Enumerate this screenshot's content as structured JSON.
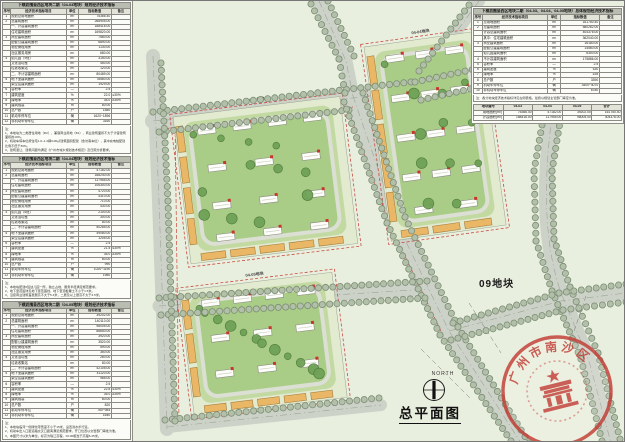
{
  "title_block": {
    "drawing_title": "总平面图",
    "north_label": "NORTH",
    "parcel_label": "09地块"
  },
  "stamp": {
    "arc_text": "广州市南沙区人民政府",
    "color": "#c23c35"
  },
  "plan": {
    "block_labels": [
      "04-03地块",
      "04-04地块",
      "04-05地块"
    ],
    "colors": {
      "background": "#e9efde",
      "road": "#cdd2c8",
      "street_tree": "#b2c0a9",
      "podium": "#e9b766",
      "tower": "#fdfdf9",
      "tree": "#6fa257",
      "red_line": "#c84b3f",
      "unit_tag": "#c8362b"
    }
  },
  "left_tables": [
    {
      "title": "下横沥围垦西区地块二期（04-03地块）规划经济技术指标",
      "header": [
        "序号",
        "经济技术指标项目",
        "单位",
        "指标数值",
        "备注"
      ],
      "rows": [
        [
          "1",
          "规划总用地面积",
          "m²",
          "75366.40",
          ""
        ],
        [
          "2",
          "总建筑面积",
          "m²",
          "268905.00",
          ""
        ],
        [
          "",
          "一、计容建筑面积",
          "m²",
          "188416.00",
          ""
        ],
        [
          "",
          "住宅建筑面积",
          "m²",
          "169820.00",
          ""
        ],
        [
          "3",
          "商业建筑面积",
          "m²",
          "7560.00",
          ""
        ],
        [
          "",
          "配套公建建筑面积",
          "m²",
          "6890.00",
          ""
        ],
        [
          "",
          "物业管理用房",
          "m²",
          "1130.00",
          ""
        ],
        [
          "",
          "社区服务用房",
          "m²",
          "680.00",
          ""
        ],
        [
          "4",
          "幼儿园（9班）",
          "m²",
          "3150.00",
          ""
        ],
        [
          "",
          "文化活动室",
          "m²",
          "450.00",
          ""
        ],
        [
          "",
          "垃圾收集站",
          "m²",
          "120.00",
          ""
        ],
        [
          "",
          "二、不计容建筑面积",
          "m²",
          "80489.00",
          ""
        ],
        [
          "5",
          "地下室建筑面积",
          "m²",
          "78560.00",
          ""
        ],
        [
          "",
          "架空层建筑面积",
          "m²",
          "1929.00",
          ""
        ],
        [
          "6",
          "容积率",
          "—",
          "2.5",
          ""
        ],
        [
          "7",
          "建筑密度",
          "%",
          "22.0",
          "≤30%"
        ],
        [
          "8",
          "绿地率",
          "%",
          "35.0",
          "≥35%"
        ],
        [
          "9",
          "建筑限高",
          "m",
          "80.00",
          ""
        ],
        [
          "10",
          "总户数",
          "户",
          "1580",
          ""
        ],
        [
          "11",
          "机动车停车位",
          "辆",
          "1620~1896",
          ""
        ],
        [
          "12",
          "非机动车停车位",
          "辆",
          "3160",
          ""
        ]
      ],
      "notes": [
        "注：",
        "1、本地块为二类居住用地（R2），兼容商业用地（B1），商业建筑面积不大于计容建筑面积的10%。",
        "2、机动车停车位按住宅1.0~1.2辆/100㎡建筑面积配建（含访客车位），其中充电桩配建比例不低于30%。",
        "3、建筑退让、建筑间距均满足《广州市城乡规划技术规定》及日照分析要求。"
      ]
    },
    {
      "title": "下横沥围垦西区地块二期（04-04地块）规划经济技术指标",
      "header": [
        "序号",
        "经济技术指标项目",
        "单位",
        "指标数值",
        "备注"
      ],
      "rows": [
        [
          "1",
          "规划总用地面积",
          "m²",
          "47182.00",
          ""
        ],
        [
          "2",
          "总建筑面积",
          "m²",
          "168240.00",
          ""
        ],
        [
          "",
          "一、计容建筑面积",
          "m²",
          "117955.00",
          ""
        ],
        [
          "",
          "住宅建筑面积",
          "m²",
          "106300.00",
          ""
        ],
        [
          "3",
          "商业建筑面积",
          "m²",
          "4720.00",
          ""
        ],
        [
          "",
          "配套公建建筑面积",
          "m²",
          "4310.00",
          ""
        ],
        [
          "",
          "物业管理用房",
          "m²",
          "710.00",
          ""
        ],
        [
          "",
          "社区服务用房",
          "m²",
          "430.00",
          ""
        ],
        [
          "4",
          "幼儿园（6班）",
          "m²",
          "2100.00",
          ""
        ],
        [
          "",
          "文化活动室",
          "m²",
          "300.00",
          ""
        ],
        [
          "",
          "垃圾收集站",
          "m²",
          "80.00",
          ""
        ],
        [
          "",
          "二、不计容建筑面积",
          "m²",
          "50285.00",
          ""
        ],
        [
          "5",
          "地下室建筑面积",
          "m²",
          "49080.00",
          ""
        ],
        [
          "",
          "架空层建筑面积",
          "m²",
          "1205.00",
          ""
        ],
        [
          "6",
          "容积率",
          "—",
          "2.5",
          ""
        ],
        [
          "7",
          "建筑密度",
          "%",
          "21.5",
          "≤30%"
        ],
        [
          "8",
          "绿地率",
          "%",
          "35.0",
          "≥35%"
        ],
        [
          "9",
          "建筑限高",
          "m",
          "80.00",
          ""
        ],
        [
          "10",
          "总户数",
          "户",
          "990",
          ""
        ],
        [
          "11",
          "机动车停车位",
          "辆",
          "1020~1190",
          ""
        ],
        [
          "12",
          "非机动车停车位",
          "辆",
          "1980",
          ""
        ]
      ],
      "notes": [
        "注：",
        "1、本地块配建6班幼儿园一所，独立占地，服务半径满足规范要求。",
        "2、地下室范围详见地下室范围线，地下室顶板覆土不小于1.5米。",
        "3、沿街商业建筑首层层高不大于5.4米，二层及以上层高不大于4.5米。"
      ]
    },
    {
      "title": "下横沥围垦西区地块二期（04-05地块）规划经济技术指标",
      "header": [
        "序号",
        "经济技术指标项目",
        "单位",
        "指标数值",
        "备注"
      ],
      "rows": [
        [
          "1",
          "规划总用地面积",
          "m²",
          "39202.00",
          ""
        ],
        [
          "2",
          "总建筑面积",
          "m²",
          "140110.00",
          ""
        ],
        [
          "",
          "一、计容建筑面积",
          "m²",
          "98005.00",
          ""
        ],
        [
          "",
          "住宅建筑面积",
          "m²",
          "88650.00",
          ""
        ],
        [
          "3",
          "商业建筑面积",
          "m²",
          "3920.00",
          ""
        ],
        [
          "",
          "配套公建建筑面积",
          "m²",
          "3520.00",
          ""
        ],
        [
          "",
          "物业管理用房",
          "m²",
          "590.00",
          ""
        ],
        [
          "",
          "社区服务用房",
          "m²",
          "350.00",
          ""
        ],
        [
          "4",
          "文化活动室",
          "m²",
          "260.00",
          ""
        ],
        [
          "",
          "垃圾收集站",
          "m²",
          "80.00",
          ""
        ],
        [
          "",
          "二、不计容建筑面积",
          "m²",
          "42105.00",
          ""
        ],
        [
          "5",
          "地下室建筑面积",
          "m²",
          "41120.00",
          ""
        ],
        [
          "",
          "架空层建筑面积",
          "m²",
          "985.00",
          ""
        ],
        [
          "6",
          "容积率",
          "—",
          "2.5",
          ""
        ],
        [
          "7",
          "建筑密度",
          "%",
          "22.8",
          "≤30%"
        ],
        [
          "8",
          "绿地率",
          "%",
          "35.0",
          "≥35%"
        ],
        [
          "9",
          "建筑限高",
          "m",
          "80.00",
          ""
        ],
        [
          "10",
          "总户数",
          "户",
          "820",
          ""
        ],
        [
          "11",
          "机动车停车位",
          "辆",
          "760~984",
          ""
        ],
        [
          "12",
          "非机动车停车位",
          "辆",
          "1640",
          ""
        ]
      ],
      "notes": [
        "注：",
        "1、本地块临河一侧绿化带宽度不小于15米，设置滨水步行道。",
        "2、机动车出入口距道路交叉口距离满足规范要求，开口位置以交警部门审批为准。",
        "3、本图尺寸以米为单位，标高为珠江高程，±0.00相当于高程6.45米。"
      ]
    }
  ],
  "right_table": {
    "title": "下横沥围垦西区地块二期（04-03、04-04、04-05地块）总体规划经济技术指标",
    "header": [
      "序号",
      "经济技术指标项目",
      "单位",
      "指标数值",
      "备注"
    ],
    "rows": [
      [
        "1",
        "总用地面积",
        "m²",
        "161750.40",
        ""
      ],
      [
        "2",
        "总建筑面积",
        "m²",
        "580262.00",
        ""
      ],
      [
        "",
        "计容总建筑面积",
        "m²",
        "404376.00",
        ""
      ],
      [
        "",
        "其中：住宅建筑面积",
        "m²",
        "362040.00",
        ""
      ],
      [
        "3",
        "商业建筑面积",
        "m²",
        "16180.00",
        ""
      ],
      [
        "",
        "配套公建建筑面积",
        "m²",
        "14560.00",
        ""
      ],
      [
        "",
        "幼儿园建筑面积",
        "m²",
        "6300.00",
        ""
      ],
      [
        "4",
        "不计容建筑面积",
        "m²",
        "175886.00",
        ""
      ],
      [
        "5",
        "容积率",
        "—",
        "2.5",
        ""
      ],
      [
        "6",
        "建筑密度",
        "%",
        "≤30",
        ""
      ],
      [
        "7",
        "绿地率",
        "%",
        "≥35",
        ""
      ],
      [
        "8",
        "总户数",
        "户",
        "3390",
        ""
      ],
      [
        "9",
        "机动车停车位",
        "辆",
        "3400~4070",
        ""
      ],
      [
        "10",
        "非机动车停车位",
        "辆",
        "6780",
        ""
      ]
    ],
    "sub_note": "注：各分地块经济技术指标详见左侧表格，最终以规划主管部门审定为准。",
    "sub_table": {
      "header": [
        "地块编号",
        "04-03",
        "04-04",
        "04-05",
        "合计"
      ],
      "rows": [
        [
          "用地面积(m²)",
          "75366.40",
          "47182.00",
          "39202.00",
          "161750.40"
        ],
        [
          "计容面积(m²)",
          "188416.00",
          "117955.00",
          "98005.00",
          "404376.00"
        ]
      ]
    }
  }
}
